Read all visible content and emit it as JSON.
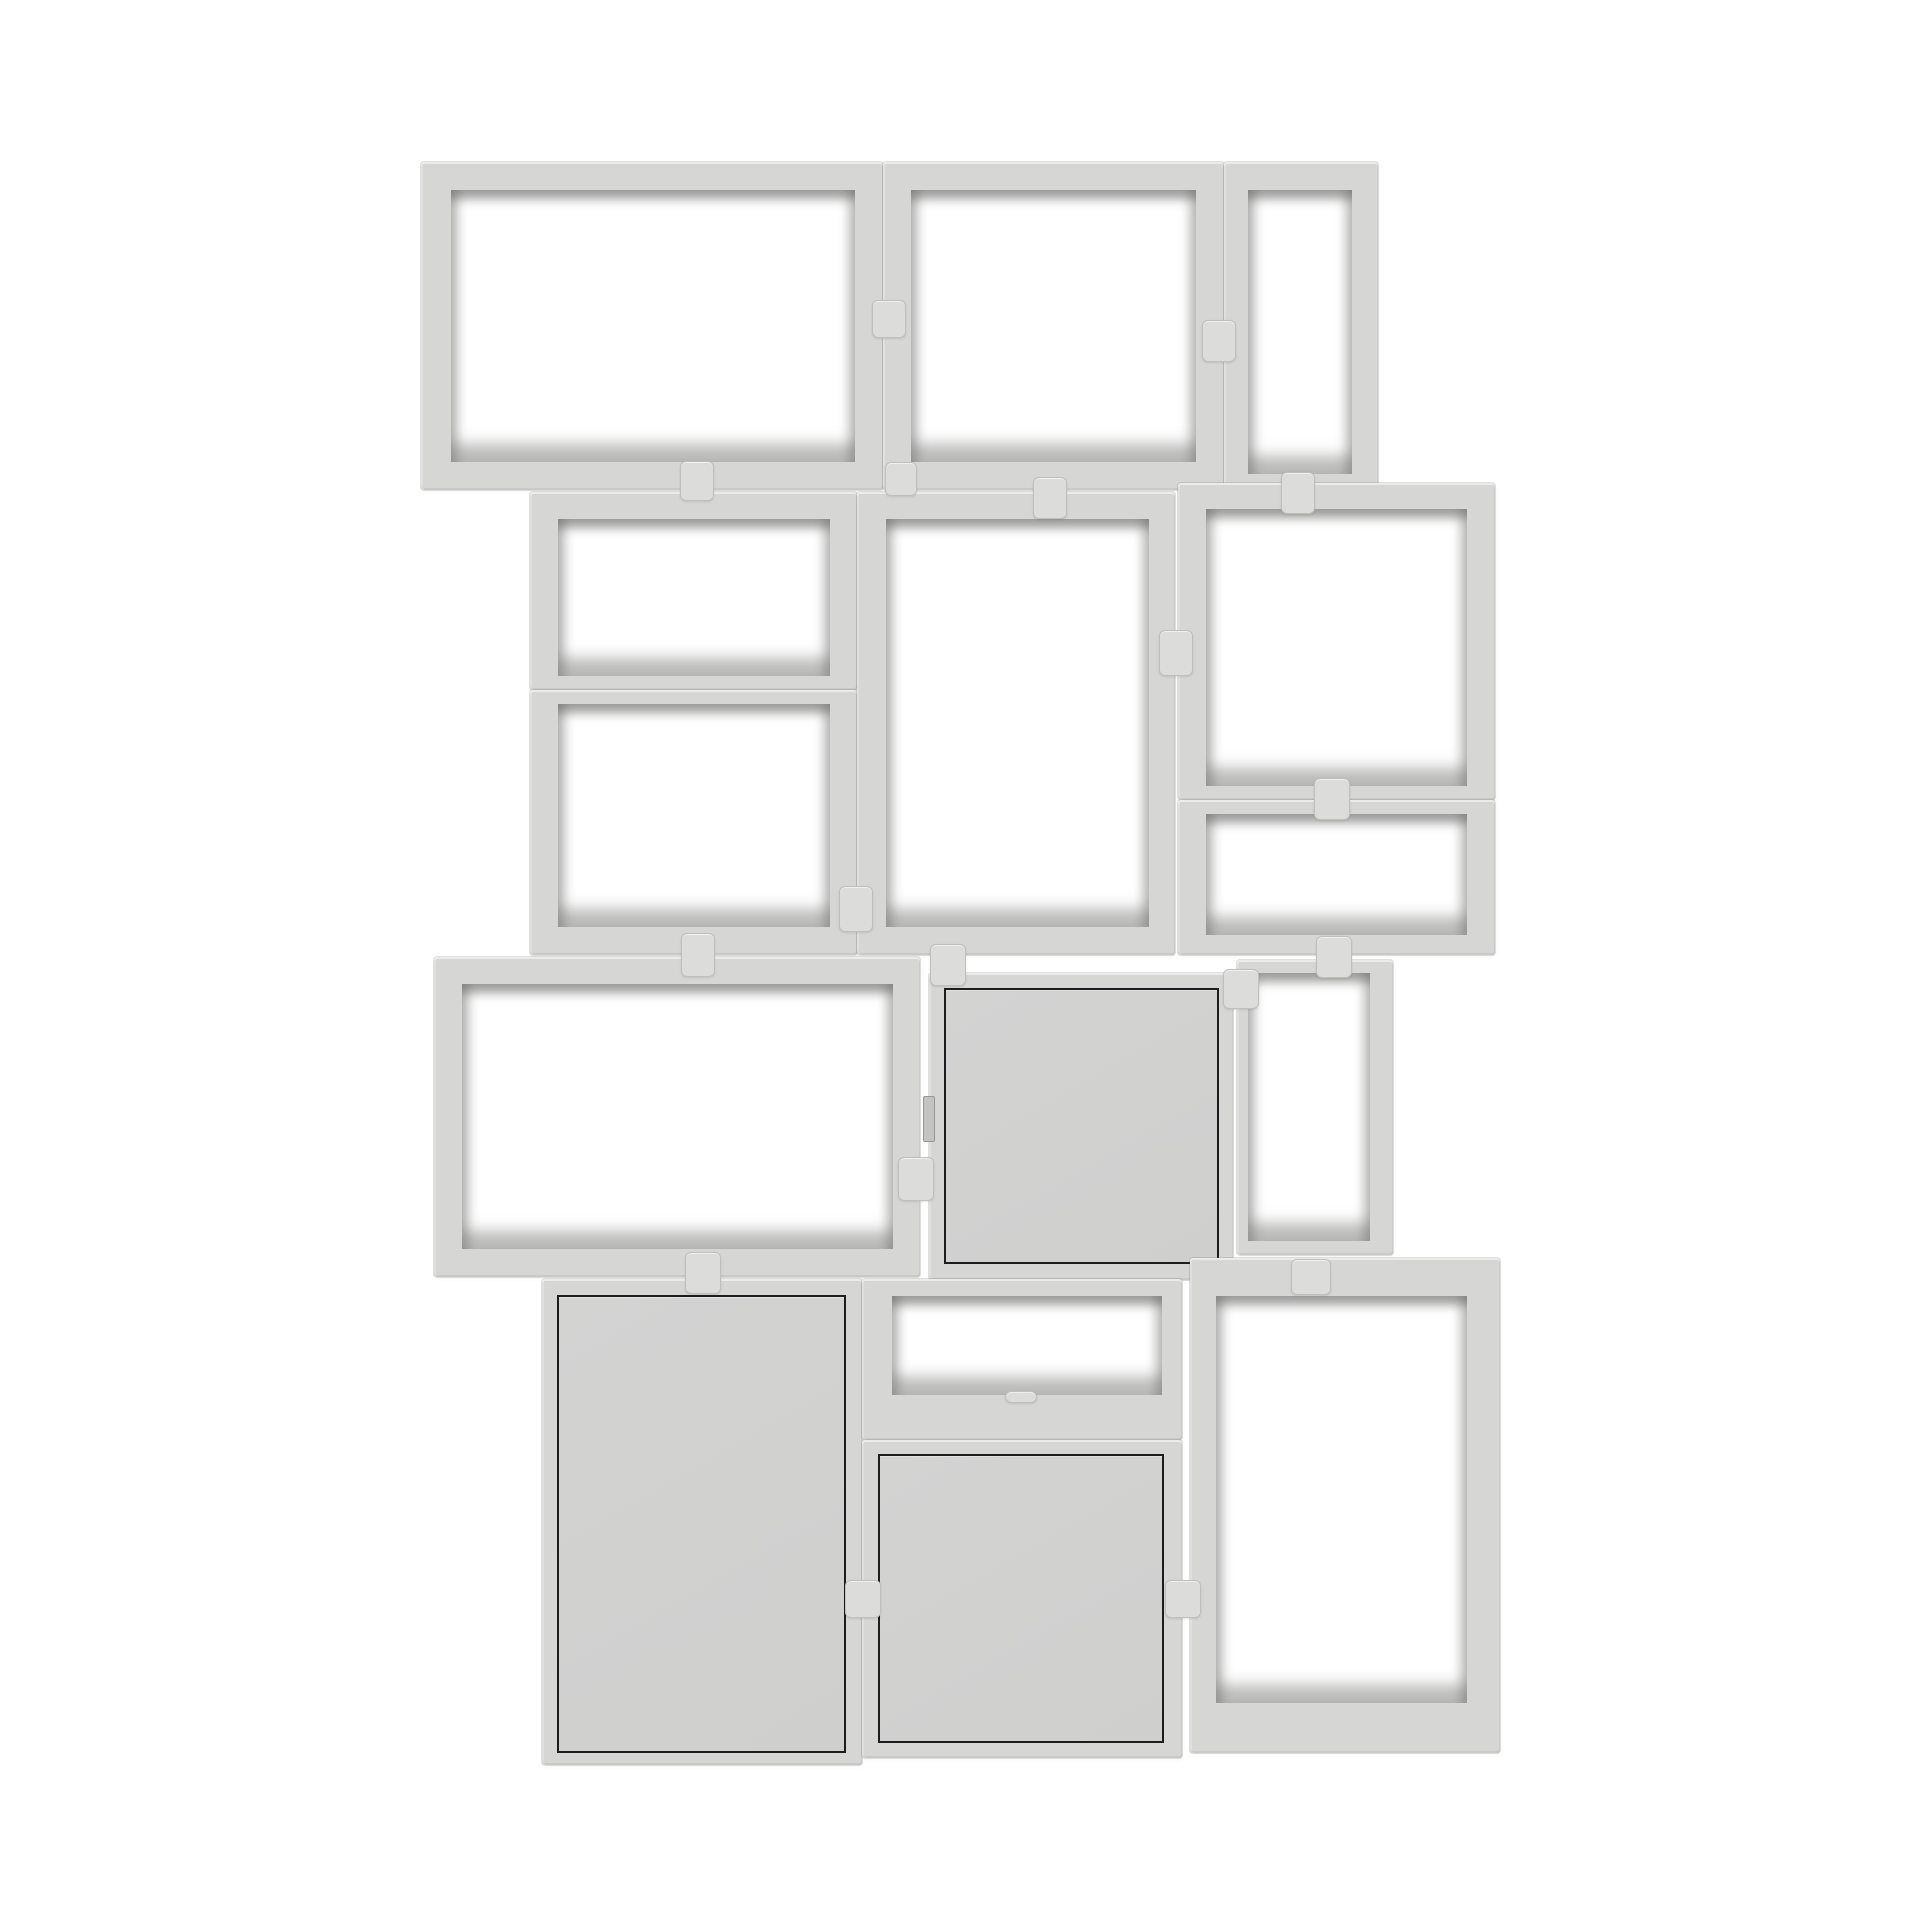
{
  "image": {
    "type": "product-photo",
    "subject": "Grey modular stacked shelving system of 15 cube modules (12 open, 3 with doors) joined by small clips, floating on a white background",
    "text_content": "none"
  },
  "canvas": {
    "width": 1920,
    "height": 1920
  },
  "palette": {
    "background": "#ffffff",
    "frame": "#d6d6d5",
    "frame_highlight": "#e4e4e3",
    "interior_shadow": "#9d9d9b",
    "interior_floor": "#c9c9c7",
    "door_panel": "#d3d3d2",
    "door_outline": "#1d1d1f",
    "clip": "#dcdcdb"
  },
  "modules": [
    {
      "id": "row1-wide-open",
      "kind": "open",
      "x": 421,
      "y": 162,
      "w": 462,
      "h": 328,
      "frame": {
        "t": 28,
        "r": 28,
        "b": 28,
        "l": 30
      }
    },
    {
      "id": "row1-square-open",
      "kind": "open",
      "x": 883,
      "y": 162,
      "w": 341,
      "h": 328,
      "frame": {
        "t": 28,
        "r": 28,
        "b": 28,
        "l": 28
      }
    },
    {
      "id": "row1-narrow-open",
      "kind": "open",
      "x": 1224,
      "y": 162,
      "w": 154,
      "h": 340,
      "frame": {
        "t": 28,
        "r": 26,
        "b": 28,
        "l": 24
      }
    },
    {
      "id": "row2-left-top-open",
      "kind": "open",
      "x": 530,
      "y": 492,
      "w": 327,
      "h": 198,
      "frame": {
        "t": 27,
        "r": 27,
        "b": 14,
        "l": 28
      }
    },
    {
      "id": "row2-left-bottom-open",
      "kind": "open",
      "x": 530,
      "y": 690,
      "w": 327,
      "h": 265,
      "frame": {
        "t": 14,
        "r": 27,
        "b": 28,
        "l": 28
      }
    },
    {
      "id": "row2-middle-tall-open",
      "kind": "open",
      "x": 857,
      "y": 492,
      "w": 318,
      "h": 463,
      "frame": {
        "t": 27,
        "r": 26,
        "b": 28,
        "l": 29
      }
    },
    {
      "id": "row2-right-open",
      "kind": "open",
      "x": 1178,
      "y": 483,
      "w": 317,
      "h": 317,
      "frame": {
        "t": 26,
        "r": 28,
        "b": 14,
        "l": 28
      }
    },
    {
      "id": "row2-right-short-open",
      "kind": "open",
      "x": 1178,
      "y": 800,
      "w": 317,
      "h": 155,
      "frame": {
        "t": 14,
        "r": 28,
        "b": 20,
        "l": 28
      }
    },
    {
      "id": "row3-wide-open",
      "kind": "open",
      "x": 434,
      "y": 957,
      "w": 486,
      "h": 320,
      "frame": {
        "t": 27,
        "r": 27,
        "b": 28,
        "l": 28
      }
    },
    {
      "id": "row3-door-closed",
      "kind": "closed",
      "x": 929,
      "y": 973,
      "w": 304,
      "h": 307,
      "door": {
        "t": 15,
        "r": 14,
        "b": 16,
        "l": 15
      }
    },
    {
      "id": "row3-narrow-open",
      "kind": "open",
      "x": 1237,
      "y": 960,
      "w": 156,
      "h": 295,
      "frame": {
        "t": 13,
        "r": 23,
        "b": 14,
        "l": 11
      }
    },
    {
      "id": "row4-left-door-closed",
      "kind": "closed",
      "x": 542,
      "y": 1279,
      "w": 320,
      "h": 486,
      "door": {
        "t": 16,
        "r": 16,
        "b": 12,
        "l": 15
      }
    },
    {
      "id": "row4-middle-shallow-open",
      "kind": "open",
      "x": 862,
      "y": 1279,
      "w": 320,
      "h": 161,
      "frame": {
        "t": 17,
        "r": 20,
        "b": 45,
        "l": 30
      }
    },
    {
      "id": "row4-middle-door-closed",
      "kind": "closed",
      "x": 862,
      "y": 1440,
      "w": 320,
      "h": 318,
      "door": {
        "t": 14,
        "r": 18,
        "b": 15,
        "l": 16
      }
    },
    {
      "id": "row4-right-open",
      "kind": "open",
      "x": 1190,
      "y": 1258,
      "w": 310,
      "h": 495,
      "frame": {
        "t": 38,
        "r": 33,
        "b": 50,
        "l": 26
      }
    }
  ],
  "clips": [
    {
      "id": "clip-row1-left-joint",
      "cx": 888,
      "cy": 318,
      "w": 32,
      "h": 36
    },
    {
      "id": "clip-row1-right-joint",
      "cx": 1218,
      "cy": 340,
      "w": 32,
      "h": 40
    },
    {
      "id": "clip-row1-row2-left",
      "cx": 696,
      "cy": 480,
      "w": 32,
      "h": 38
    },
    {
      "id": "clip-row1-row2-mid1",
      "cx": 900,
      "cy": 478,
      "w": 30,
      "h": 32
    },
    {
      "id": "clip-row1-row2-mid2",
      "cx": 1049,
      "cy": 497,
      "w": 32,
      "h": 40
    },
    {
      "id": "clip-row1-row2-right",
      "cx": 1297,
      "cy": 492,
      "w": 32,
      "h": 40
    },
    {
      "id": "clip-row2-left-mid-joint",
      "cx": 855,
      "cy": 908,
      "w": 32,
      "h": 44
    },
    {
      "id": "clip-row2-mid-right-joint",
      "cx": 1175,
      "cy": 652,
      "w": 32,
      "h": 44
    },
    {
      "id": "clip-row2-right-shelf",
      "cx": 1331,
      "cy": 798,
      "w": 34,
      "h": 40
    },
    {
      "id": "clip-row2-row3-left",
      "cx": 697,
      "cy": 954,
      "w": 32,
      "h": 42
    },
    {
      "id": "clip-row2-row3-mid",
      "cx": 947,
      "cy": 964,
      "w": 34,
      "h": 40
    },
    {
      "id": "clip-row2-row3-right",
      "cx": 1333,
      "cy": 956,
      "w": 34,
      "h": 40
    },
    {
      "id": "clip-row3-mid-joint",
      "cx": 915,
      "cy": 1178,
      "w": 34,
      "h": 42
    },
    {
      "id": "clip-row3-right-joint",
      "cx": 1240,
      "cy": 988,
      "w": 34,
      "h": 38
    },
    {
      "id": "clip-row3-row4-left",
      "cx": 702,
      "cy": 1272,
      "w": 34,
      "h": 40
    },
    {
      "id": "clip-row3-row4-right",
      "cx": 1310,
      "cy": 1276,
      "w": 38,
      "h": 34
    },
    {
      "id": "clip-row4-left-joint",
      "cx": 862,
      "cy": 1598,
      "w": 34,
      "h": 36
    },
    {
      "id": "clip-row4-right-joint",
      "cx": 1182,
      "cy": 1598,
      "w": 34,
      "h": 36
    },
    {
      "id": "clip-row4-shelf-tab",
      "cx": 1020,
      "cy": 1396,
      "w": 30,
      "h": 10
    }
  ],
  "hinges": [
    {
      "id": "hinge-row3-door",
      "cx": 928,
      "cy": 1118,
      "w": 10,
      "h": 44
    }
  ]
}
